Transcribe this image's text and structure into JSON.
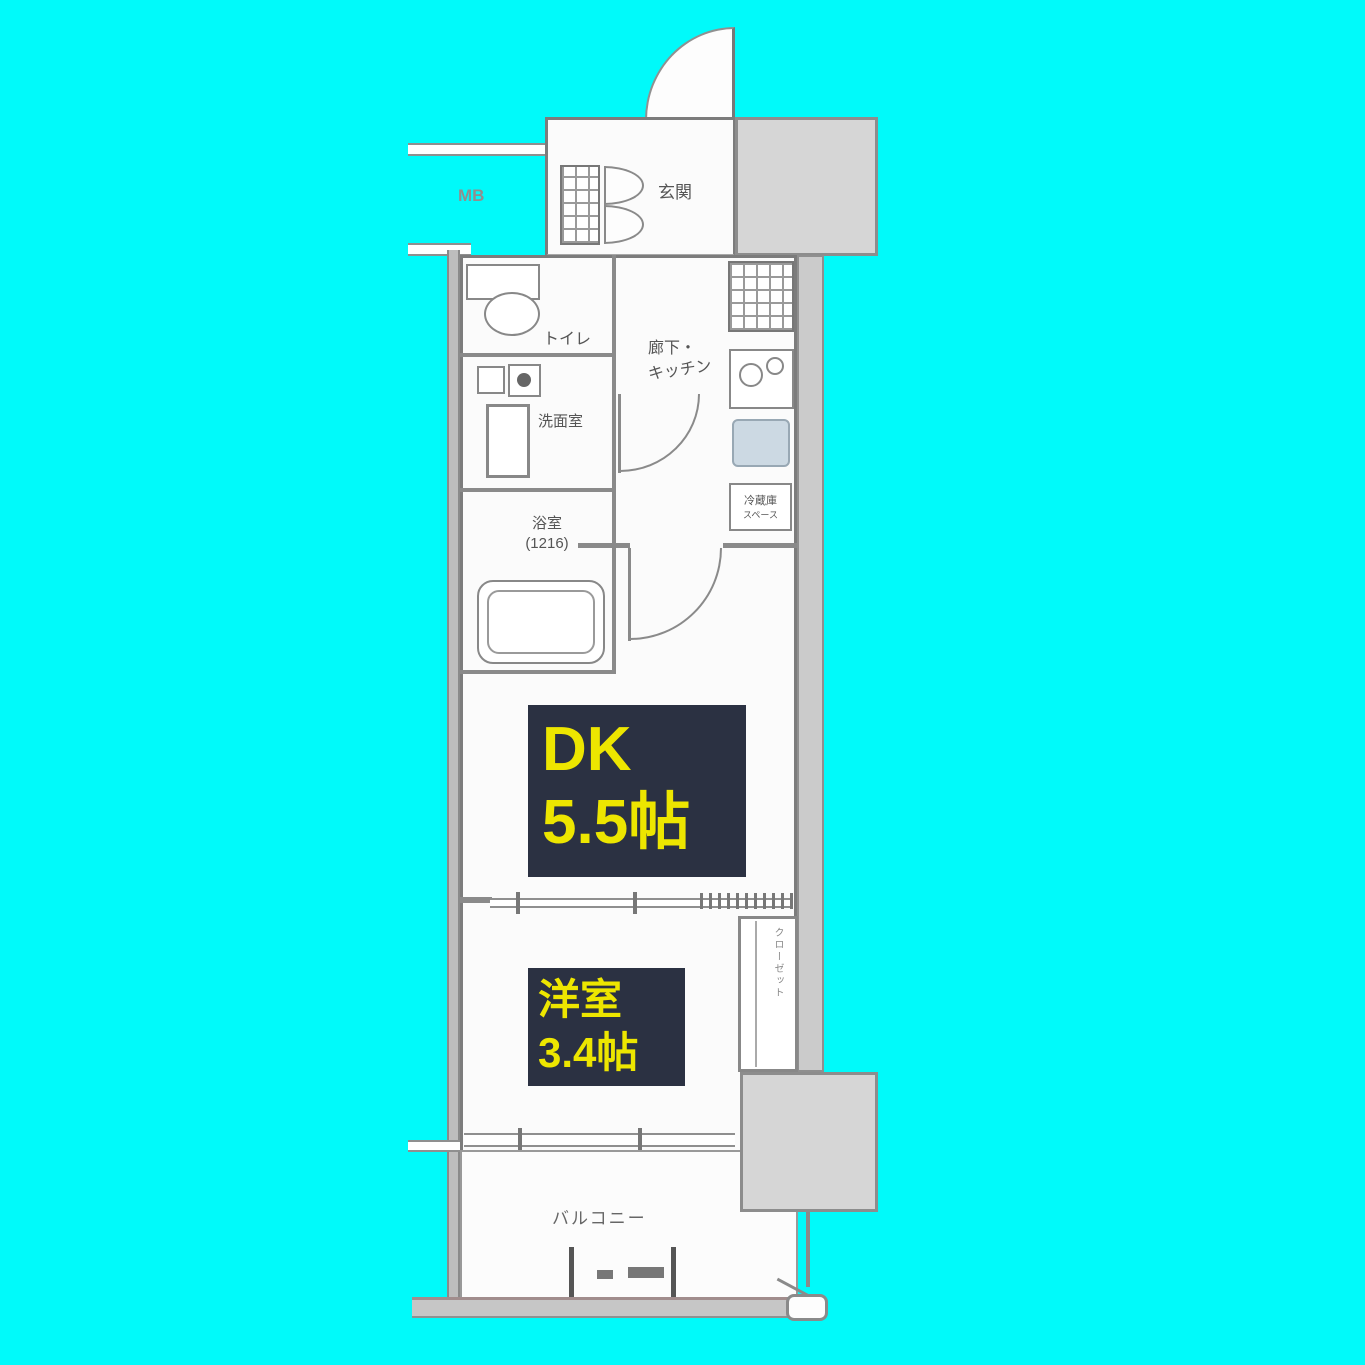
{
  "plan": {
    "meter_box": "MB",
    "entrance_label": "玄関",
    "toilet_label": "トイレ",
    "washroom_label": "洗面室",
    "bath_label": "浴室",
    "bath_size": "(1216)",
    "hallway_label_1": "廊下・",
    "hallway_label_2": "キッチン",
    "fridge_label_1": "冷蔵庫",
    "fridge_label_2": "スペース",
    "closet_label": "クローゼット",
    "dk": {
      "name": "DK",
      "size": "5.5帖"
    },
    "western": {
      "name": "洋室",
      "size": "3.4帖"
    },
    "balcony_label": "バルコニー",
    "colors": {
      "background": "#00fafa",
      "highlight_bg": "#2b3142",
      "highlight_text": "#ede600",
      "neighbor_gray": "#d6d6d6",
      "wall_gray": "#8a8a8a"
    }
  }
}
